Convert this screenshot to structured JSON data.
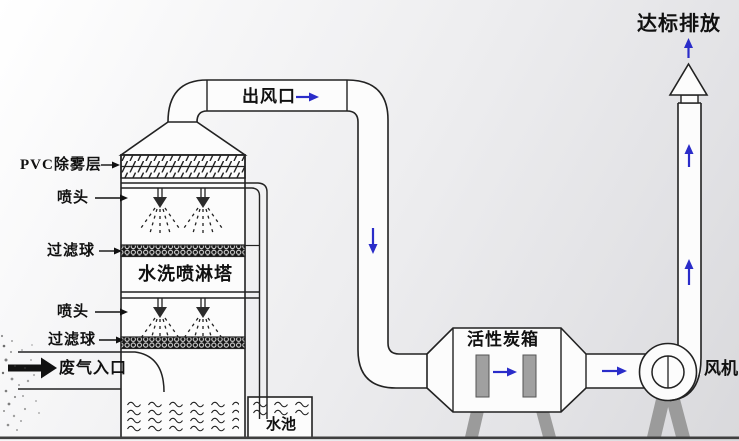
{
  "diagram": {
    "labels": {
      "pvc_demister_layer": "PVC除雾层",
      "spray_nozzle_upper": "喷头",
      "filter_ball_upper": "过滤球",
      "spray_tower_name": "水洗喷淋塔",
      "spray_nozzle_lower": "喷头",
      "filter_ball_lower": "过滤球",
      "waste_gas_inlet": "废气入口",
      "water_pool": "水池",
      "air_outlet": "出风口",
      "compliant_emission": "达标排放",
      "activated_carbon_box": "活性炭箱",
      "fan": "风机"
    },
    "colors": {
      "line": "#222222",
      "flow_arrow_blue": "#2a2cc9",
      "metal_gray": "#a0a0a0",
      "filter_band_dark": "#161616",
      "ground_line": "#3f3f3f",
      "background_light": "#ffffff",
      "background_dark": "#d9d9dc"
    }
  }
}
